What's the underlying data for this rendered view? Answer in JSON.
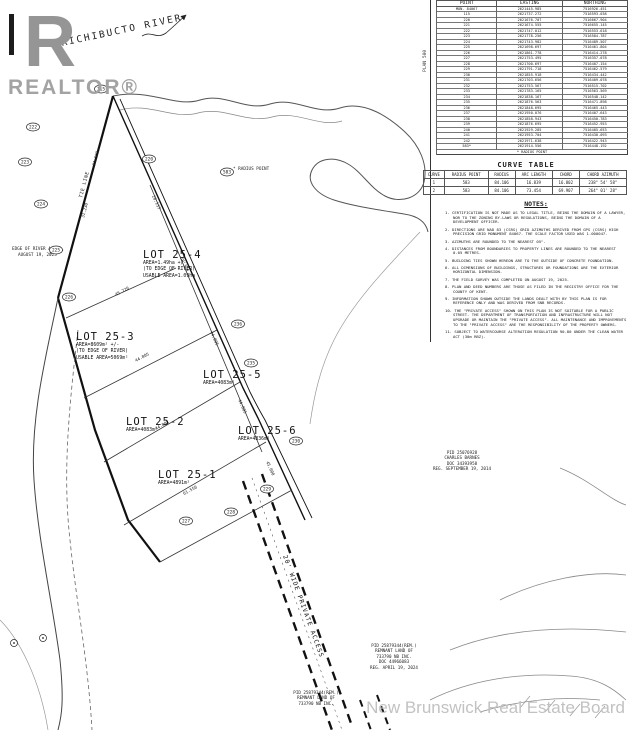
{
  "branding": {
    "logo_r": "R",
    "logo_word": "REALTOR®",
    "watermark": "New Brunswick Real Estate Board"
  },
  "plan": {
    "river_label": "RICHIBUCTO RIVER",
    "tie_line_label": "TIE LINE",
    "radius_point_label": "* RADIUS POINT",
    "access_label": "20' WIDE PRIVATE ACCESS",
    "plan_ref": "PLAN 500",
    "edge_note_lines": [
      "EDGE OF RIVER AS OF",
      "AUGUST 19, 2025"
    ],
    "point_markers": [
      {
        "label": "115",
        "x": 101,
        "y": 89
      },
      {
        "label": "220",
        "x": 149,
        "y": 159
      },
      {
        "label": "222",
        "x": 33,
        "y": 127
      },
      {
        "label": "223",
        "x": 25,
        "y": 162
      },
      {
        "label": "224",
        "x": 41,
        "y": 204
      },
      {
        "label": "225",
        "x": 56,
        "y": 250
      },
      {
        "label": "226",
        "x": 69,
        "y": 297
      },
      {
        "label": "227",
        "x": 186,
        "y": 521
      },
      {
        "label": "228",
        "x": 231,
        "y": 512
      },
      {
        "label": "229",
        "x": 267,
        "y": 489
      },
      {
        "label": "230",
        "x": 296,
        "y": 441
      },
      {
        "label": "235",
        "x": 251,
        "y": 363
      },
      {
        "label": "236",
        "x": 238,
        "y": 324
      },
      {
        "label": "583",
        "x": 227,
        "y": 172
      }
    ],
    "dimension_labels": [
      {
        "text": "24.593",
        "x": 95,
        "y": 166,
        "rot": -75
      },
      {
        "text": "31.230",
        "x": 84,
        "y": 218,
        "rot": -75
      },
      {
        "text": "45.720",
        "x": 116,
        "y": 296,
        "rot": -28
      },
      {
        "text": "44.805",
        "x": 136,
        "y": 362,
        "rot": -28
      },
      {
        "text": "44.805",
        "x": 156,
        "y": 430,
        "rot": -28
      },
      {
        "text": "61.550",
        "x": 184,
        "y": 495,
        "rot": -28
      },
      {
        "text": "20.117",
        "x": 152,
        "y": 196,
        "rot": 66
      },
      {
        "text": "58.370",
        "x": 180,
        "y": 258,
        "rot": 66
      },
      {
        "text": "44.805",
        "x": 210,
        "y": 332,
        "rot": 66
      },
      {
        "text": "44.805",
        "x": 238,
        "y": 400,
        "rot": 66
      },
      {
        "text": "45.000",
        "x": 266,
        "y": 462,
        "rot": 66
      }
    ],
    "monuments": [
      {
        "x": 43,
        "y": 638
      },
      {
        "x": 14,
        "y": 643
      }
    ]
  },
  "point_table": {
    "columns": [
      "POINT",
      "EASTING",
      "NORTHING"
    ],
    "rows": [
      [
        "MON. 84067",
        "2621445.985",
        "7516926.451"
      ],
      [
        "115",
        "2621737.272",
        "7516593.038"
      ],
      [
        "220",
        "2621676.707",
        "7516667.904"
      ],
      [
        "221",
        "2621674.555",
        "7516655.145"
      ],
      [
        "222",
        "2621747.012",
        "7516553.618"
      ],
      [
        "223",
        "2621778.256",
        "7516584.787"
      ],
      [
        "224",
        "2621743.982",
        "7516489.507"
      ],
      [
        "225",
        "2621698.697",
        "7516461.804"
      ],
      [
        "226",
        "2621861.778",
        "7516414.278"
      ],
      [
        "227",
        "2621753.495",
        "7516357.078"
      ],
      [
        "228",
        "2621700.697",
        "7516407.154"
      ],
      [
        "229",
        "2621791.718",
        "7516462.579"
      ],
      [
        "230",
        "2621855.918",
        "7516434.442"
      ],
      [
        "231",
        "2621703.656",
        "7516409.078"
      ],
      [
        "232",
        "2621753.567",
        "7516515.702"
      ],
      [
        "233",
        "2621783.165",
        "7516563.569"
      ],
      [
        "234",
        "2621838.167",
        "7516548.142"
      ],
      [
        "235",
        "2621876.563",
        "7516471.898"
      ],
      [
        "236",
        "2621848.695",
        "7516465.443"
      ],
      [
        "237",
        "2621950.076",
        "7516407.643"
      ],
      [
        "238",
        "2621858.943",
        "7516450.783"
      ],
      [
        "239",
        "2621876.695",
        "7516452.953"
      ],
      [
        "240",
        "2621929.285",
        "7516405.653"
      ],
      [
        "241",
        "2621953.704",
        "7516430.093"
      ],
      [
        "242",
        "2621971.638",
        "7516422.943"
      ],
      [
        "583*",
        "2621914.556",
        "7516448.192"
      ]
    ],
    "footnote": "* RADIUS POINT"
  },
  "curve_table": {
    "title": "CURVE TABLE",
    "columns": [
      "CURVE",
      "RADIUS POINT",
      "RADIUS",
      "ARC LENGTH",
      "CHORD",
      "CHORD AZIMUTH"
    ],
    "rows": [
      [
        "1",
        "583",
        "84.106",
        "16.839",
        "16.802",
        "238° 54' 58\""
      ],
      [
        "2",
        "583",
        "84.106",
        "73.454",
        "69.907",
        "264° 01' 28\""
      ]
    ]
  },
  "notes": {
    "title": "NOTES:",
    "items": [
      "CERTIFICATION IS NOT MADE AS TO LEGAL TITLE, BEING THE DOMAIN OF A LAWYER, NOR TO THE ZONING BY-LAWS OR REGULATIONS, BEING THE DOMAIN OF A DEVELOPMENT OFFICER.",
      "DIRECTIONS ARE NAD 83 (CSRS) GRID AZIMUTHS DERIVED FROM GPS (CSRS) HIGH PRECISION GRID MONUMENT 84067. THE SCALE FACTOR USED WAS 1.000047.",
      "AZIMUTHS ARE ROUNDED TO THE NEAREST 05\".",
      "DISTANCES FROM BOUNDARIES TO PROPERTY LINES ARE ROUNDED TO THE NEAREST 0.05 METRES.",
      "BUILDING TIES SHOWN HEREON ARE TO THE OUTSIDE OF CONCRETE FOUNDATION.",
      "ALL DIMENSIONS OF BUILDINGS, STRUCTURES OR FOUNDATIONS ARE THE EXTERIOR HORIZONTAL DIMENSION.",
      "THE FIELD SURVEY WAS COMPLETED ON AUGUST 19, 2025.",
      "PLAN AND DEED NUMBERS ARE THOSE AS FILED IN THE REGISTRY OFFICE FOR THE COUNTY OF KENT.",
      "INFORMATION SHOWN OUTSIDE THE LANDS DEALT WITH BY THIS PLAN IS FOR REFERENCE ONLY AND WAS DERIVED FROM SNB RECORDS.",
      "THE \"PRIVATE ACCESS\" SHOWN ON THIS PLAN IS NOT SUITABLE FOR A PUBLIC STREET. THE DEPARTMENT OF TRANSPORTATION AND INFRASTRUCTURE WILL NOT UPGRADE OR MAINTAIN THE \"PRIVATE ACCESS\". ALL MAINTENANCE AND IMPROVEMENTS TO THE \"PRIVATE ACCESS\" ARE THE RESPONSIBILITY OF THE PROPERTY OWNERS.",
      "SUBJECT TO WATERCOURSE ALTERATION REGULATION 90-80 UNDER THE CLEAN WATER ACT (30m RBZ)."
    ]
  },
  "lots": [
    {
      "name": "LOT 25-4",
      "lines": [
        "AREA=1.49ha +/-",
        "(TO EDGE OF RIVER)",
        "USABLE AREA=1.09ha"
      ]
    },
    {
      "name": "LOT 25-3",
      "lines": [
        "AREA=8609m² +/-",
        "(TO EDGE OF RIVER)",
        "USABLE AREA=5069m²"
      ]
    },
    {
      "name": "LOT 25-5",
      "lines": [
        "AREA=4083m²"
      ]
    },
    {
      "name": "LOT 25-2",
      "lines": [
        "AREA=4083m²"
      ]
    },
    {
      "name": "LOT 25-6",
      "lines": [
        "AREA=4836m²"
      ]
    },
    {
      "name": "LOT 25-1",
      "lines": [
        "AREA=4891m²"
      ]
    }
  ],
  "parcels": [
    {
      "lines": [
        "PID 25076928",
        "CHARLES BARNES",
        "DOC 34393958",
        "REG. SEPTEMBER 19, 2014"
      ]
    },
    {
      "lines": [
        "PID 25879344(REM.)",
        "REMNANT LAND OF",
        "733790 NB INC.",
        "DOC 44966083",
        "REG. APRIL 19, 2024"
      ]
    },
    {
      "lines": [
        "PID 25879344(REM.)",
        "REMNANT LAND OF",
        "733790 NB INC."
      ]
    }
  ]
}
